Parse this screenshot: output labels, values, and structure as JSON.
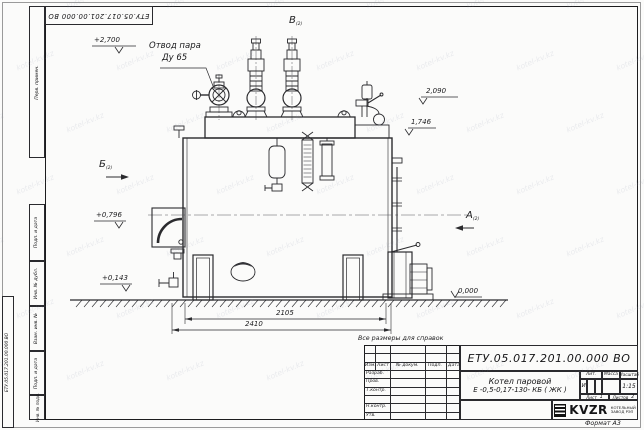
{
  "sheet": {
    "doc_number": "ЕТУ.05.017.201.00.000  ВО",
    "format_note": "Формат А3",
    "ref_note": "Все размеры для справок",
    "watermark_text": "kotel-kv.kz"
  },
  "frame_labels": {
    "col1": "Перв. примен.",
    "col2": "Подп. и дата",
    "col3": "Инв. № дубл.",
    "col4": "Взам. инв. №",
    "col5": "Подп. и дата",
    "col6": "Инв. № подл."
  },
  "annotations": {
    "steam_outlet_1": "Отвод пара",
    "steam_outlet_2": "Ду 65",
    "elev_2700": "+2,700",
    "elev_2090": "2,090",
    "elev_1746": "1,746",
    "elev_0796": "+0,796",
    "elev_0143": "+0,143",
    "elev_0000": "0,000",
    "view_top": "В",
    "view_left": "Б",
    "view_right": "А",
    "view_sub": "(2)",
    "dim_inner": "2105",
    "dim_outer": "2410"
  },
  "title_block": {
    "doc_number": "ЕТУ.05.017.201.00.000  ВО",
    "product_line1": "Котел паровой",
    "product_line2": "Е -0,5-0,17-130- КБ ( ЖК )",
    "header": {
      "izm": "Изм.",
      "list": "Лист",
      "doc": "№ докум.",
      "podp": "Подп.",
      "data": "Дата"
    },
    "rows": [
      "Разраб.",
      "Пров.",
      "Т.контр.",
      "",
      "Н.контр.",
      "Утв."
    ],
    "lit_label": "Лит.",
    "lit_value": "И",
    "mass_label": "Масса",
    "scale_label": "Масштаб",
    "scale_value": "1:15",
    "sheet_label": "Лист",
    "sheet_no": "1",
    "sheets_label": "Листов",
    "sheets_total": "2",
    "logo": "KVZR",
    "org_line1": "КОТЕЛЬНЫЙ",
    "org_line2": "ЗАВОД РЭП"
  }
}
